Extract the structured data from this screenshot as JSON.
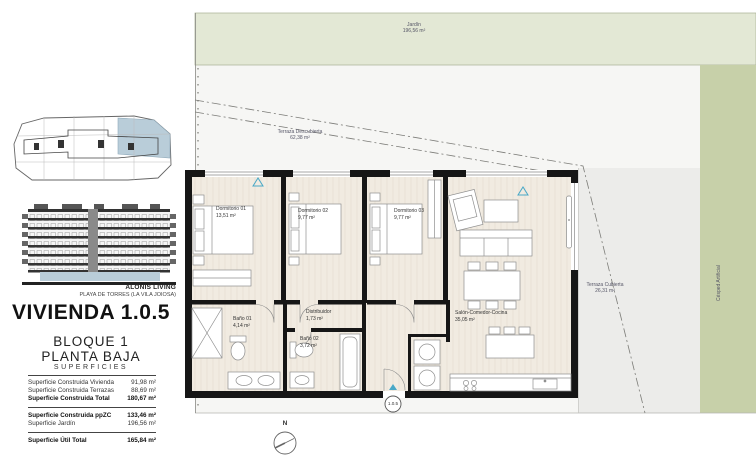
{
  "panel": {
    "brand": "ALONIS LIVING",
    "location": "PLAYA DE TORRES (LA VILA JOIOSA)",
    "title": "VIVIENDA 1.0.5",
    "block": "BLOQUE 1",
    "floor": "PLANTA BAJA",
    "table_title": "SUPERFICIES",
    "rows": [
      {
        "label": "Superficie Construida Vivienda",
        "value": "91,98 m²"
      },
      {
        "label": "Superficie Construida Terrazas",
        "value": "88,69 m²"
      },
      {
        "label": "Superficie Construida Total",
        "value": "180,67 m²"
      },
      {
        "label": "Superficie Construida ppZC",
        "value": "133,46 m²"
      },
      {
        "label": "Superficie Jardín",
        "value": "196,56 m²"
      },
      {
        "label": "Superficie Útil Total",
        "value": "165,84 m²"
      }
    ]
  },
  "plan": {
    "unit_marker": "1.0.5",
    "north_label": "N",
    "jardin": {
      "name": "Jardín",
      "area": "196,56 m²"
    },
    "terraza_descubierta": {
      "name": "Terraza Descubierta",
      "area": "62,38 m²"
    },
    "terraza_cubierta": {
      "name": "Terraza Cubierta",
      "area": "26,31 m²"
    },
    "cesped": {
      "name": "Césped Artificial"
    },
    "rooms": [
      {
        "name": "Dormitorio 01",
        "area": "13,51 m²"
      },
      {
        "name": "Dormitorio 02",
        "area": "9,77 m²"
      },
      {
        "name": "Dormitorio 03",
        "area": "9,77 m²"
      },
      {
        "name": "Salón-Comedor-Cocina",
        "area": "35,05 m²"
      },
      {
        "name": "Distribuidor",
        "area": "1,73 m²"
      },
      {
        "name": "Baño 01",
        "area": "4,14 m²"
      },
      {
        "name": "Baño 02",
        "area": "3,72 m²"
      }
    ],
    "colors": {
      "jardin_green": "#e3e8d5",
      "cesped_green": "#c7d0a9",
      "terrace_gray": "#ececea",
      "site_white": "#f6f6f4",
      "floor_cream": "#f1ebe1",
      "wall_black": "#161616",
      "accent_blue": "#49a8c7",
      "keyplan_blue": "#b9cdd9"
    }
  }
}
